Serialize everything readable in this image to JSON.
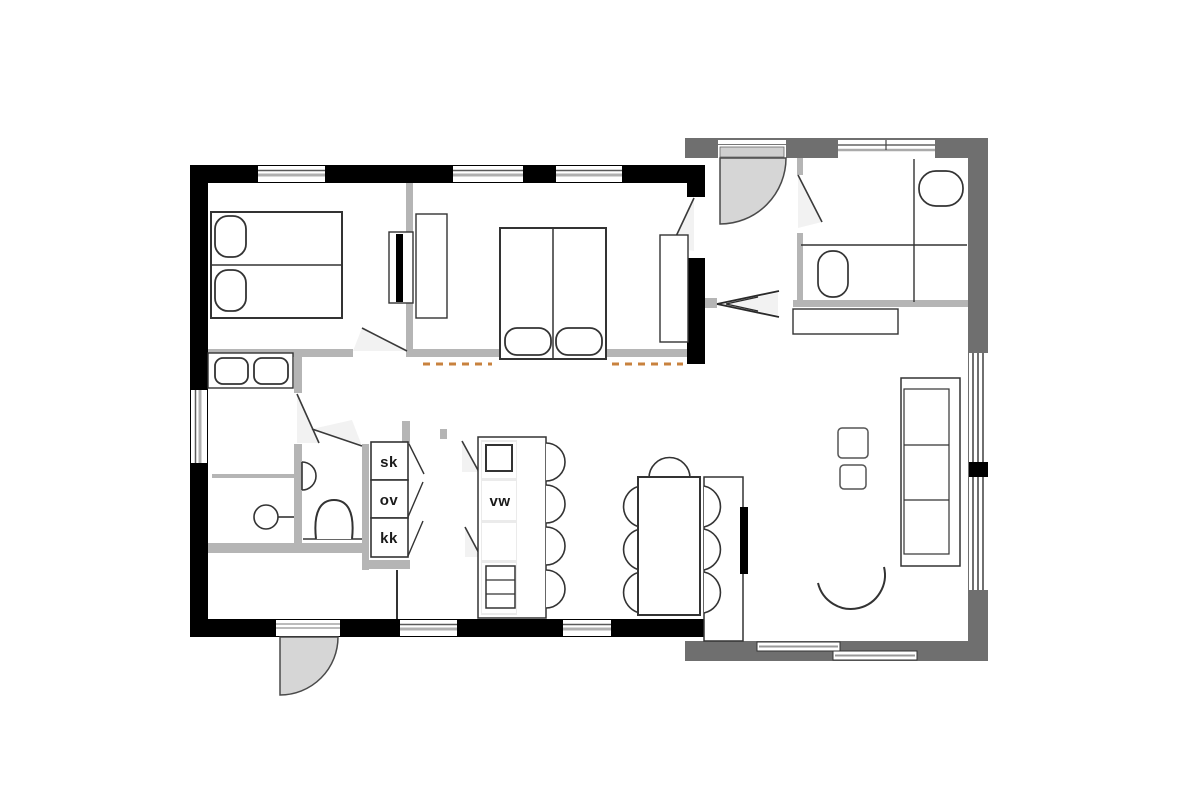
{
  "floor_plan": {
    "labels": {
      "cabinet_top": "sk",
      "cabinet_middle": "ov",
      "cabinet_bottom": "kk",
      "island_unit": "vw"
    },
    "colors": {
      "background": "#ffffff",
      "exterior_wall_main": "#000000",
      "exterior_wall_annex": "#6f6f6f",
      "partition_wall": "#b5b5b5",
      "door_swing_fill": "#f2f2f2",
      "door_leaf_fill": "#d6d6d6",
      "dashed_marker": "#c8823e",
      "furniture_outline": "#333333"
    }
  }
}
